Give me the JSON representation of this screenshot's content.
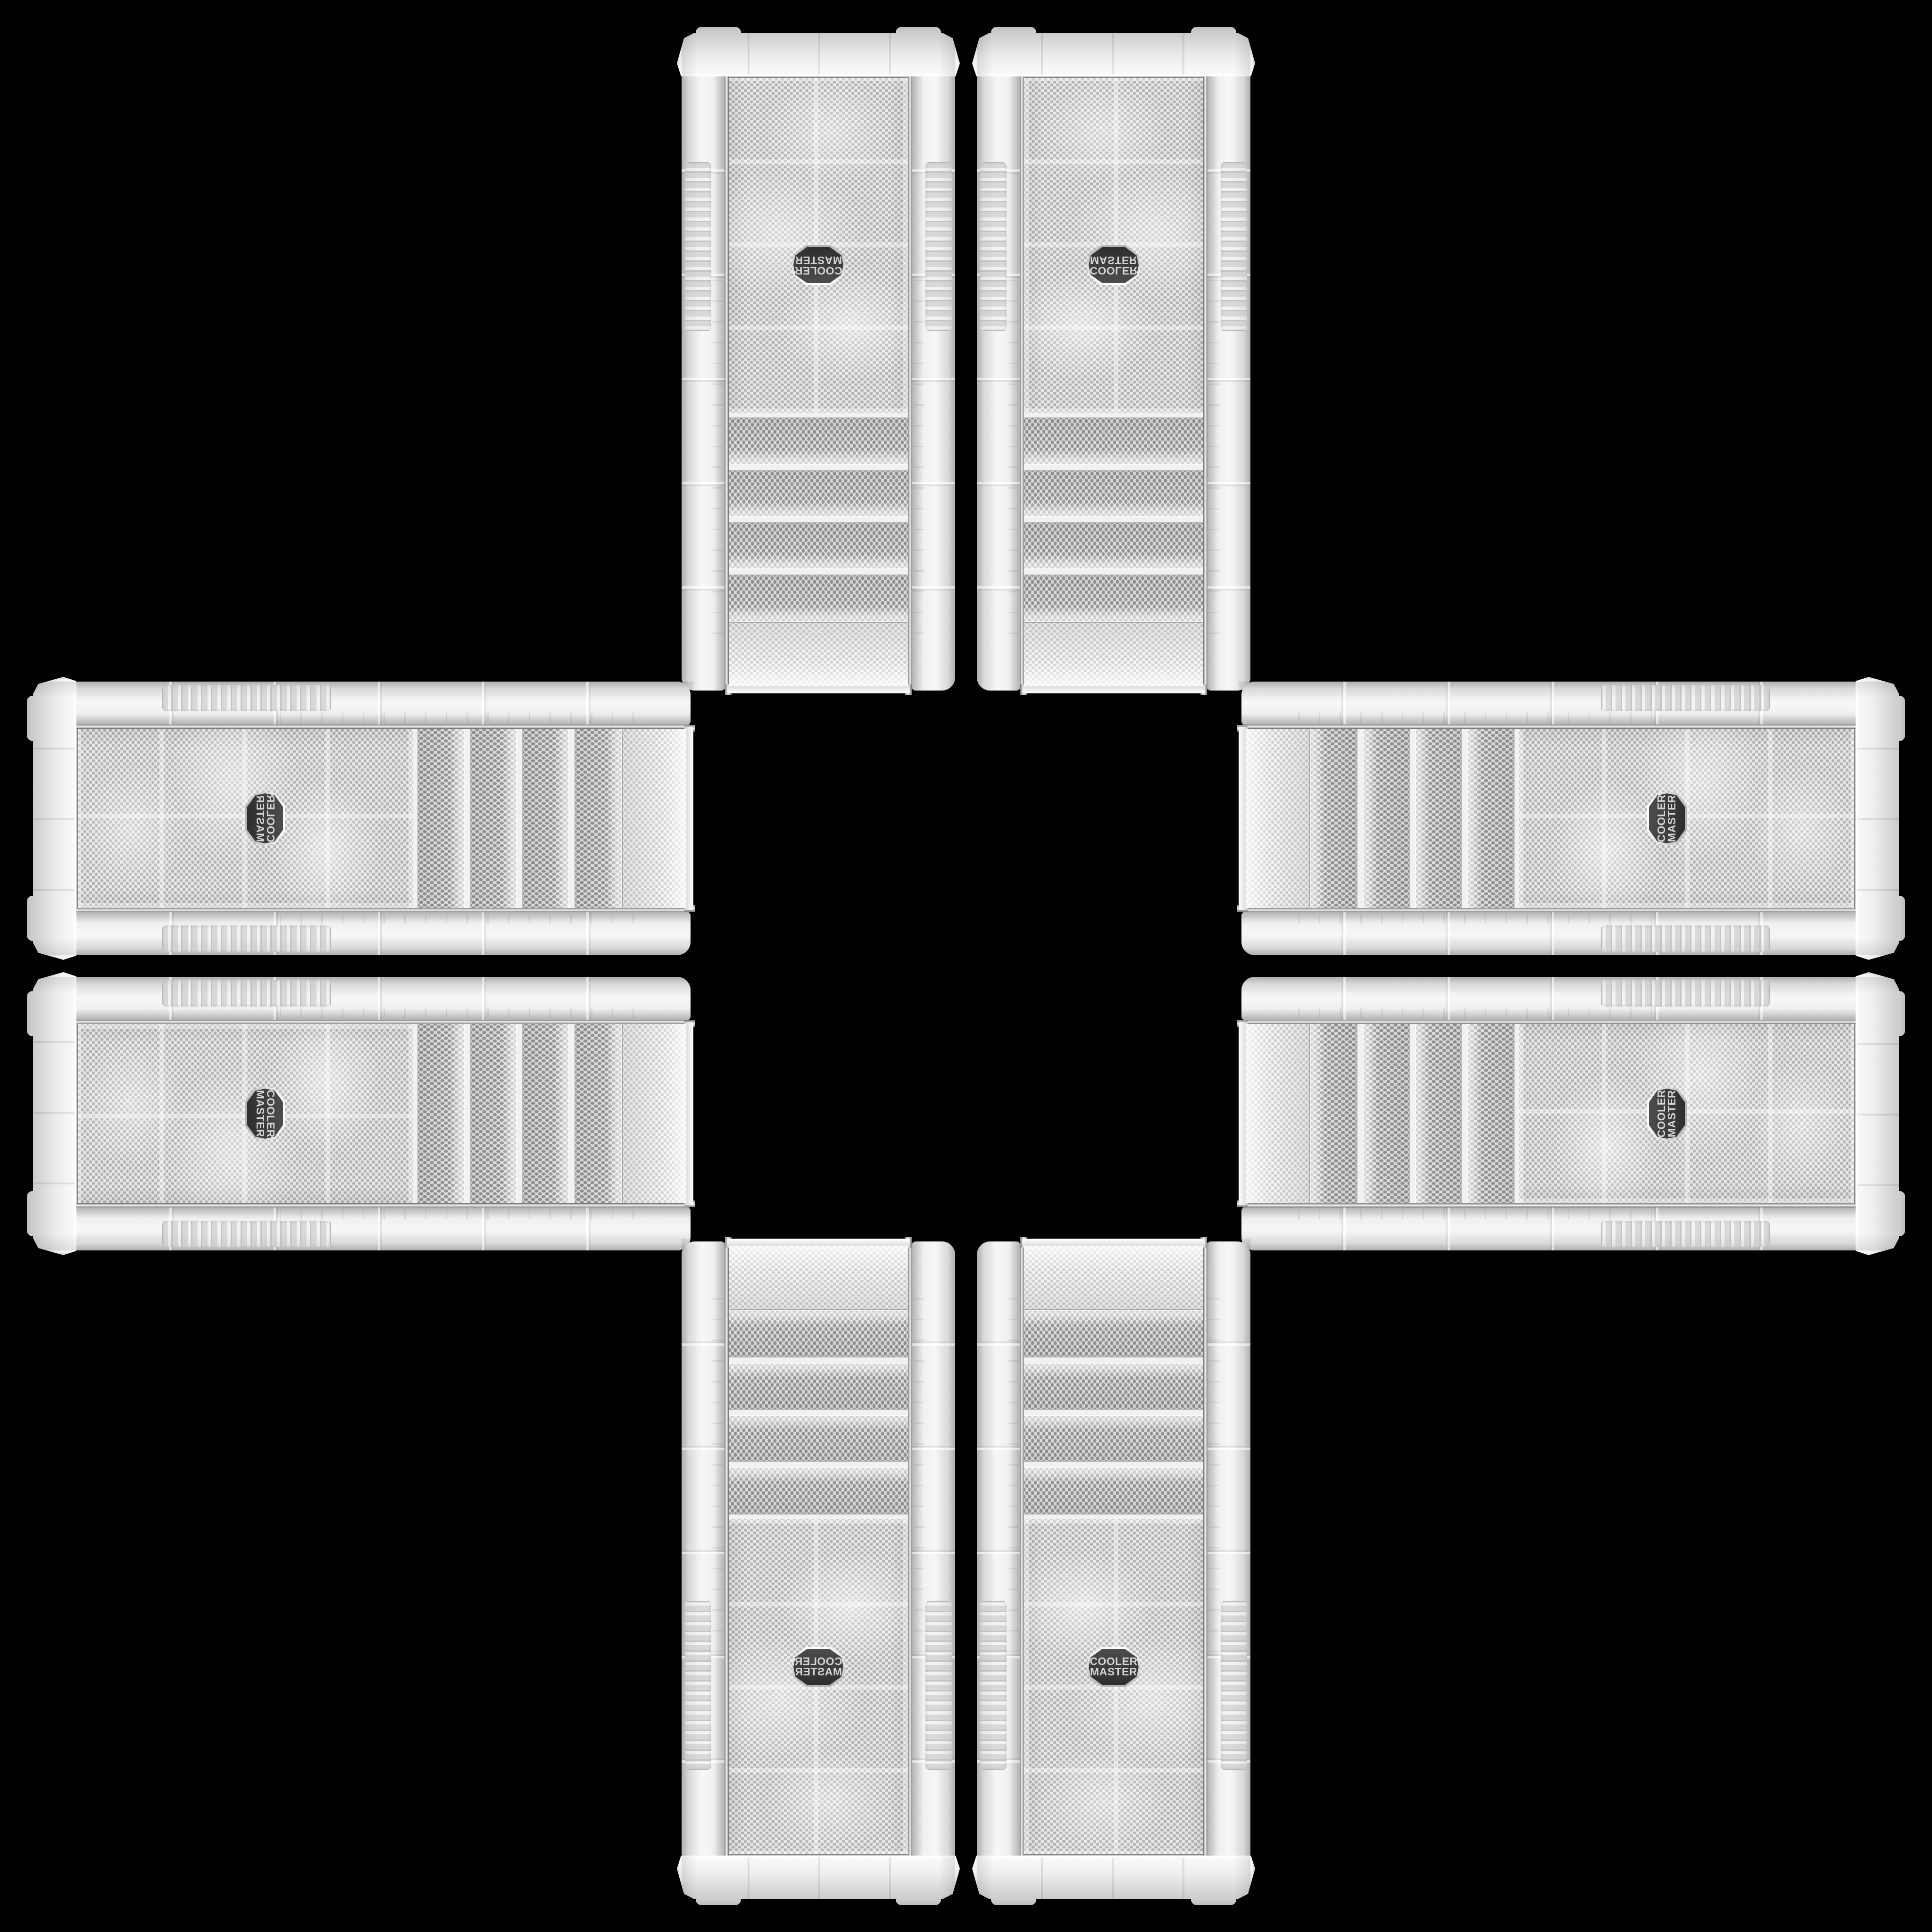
{
  "scene": {
    "background": "#000000",
    "layout": "cross-collage",
    "case_count": 8
  },
  "brand": {
    "line1": "COOLER",
    "line2": "MASTER"
  },
  "colors": {
    "background": "#000000",
    "case_body": "#ededed",
    "mesh_light": "#e9e9e9",
    "mesh_dot": "#9b9b9b",
    "chrome": "#8c8c8c",
    "badge_bg": "#39393b",
    "badge_text": "#d4d4d4"
  },
  "cases": {
    "instances": [
      {
        "name": "case-tower-top-left",
        "class": "tower-tl",
        "orientation": "rotated-180"
      },
      {
        "name": "case-tower-top-right",
        "class": "tower-tr",
        "orientation": "flipped-vertical"
      },
      {
        "name": "case-horizontal-left-top",
        "class": "horiz-lt",
        "orientation": "rotated-90ccw-mirrored-horizontal"
      },
      {
        "name": "case-horizontal-right-top",
        "class": "horiz-rt",
        "orientation": "rotated-90ccw"
      },
      {
        "name": "case-horizontal-left-bottom",
        "class": "horiz-lb",
        "orientation": "rotated-90ccw-rotated-180"
      },
      {
        "name": "case-horizontal-right-bottom",
        "class": "horiz-rb",
        "orientation": "rotated-90ccw-flipped-vertical"
      },
      {
        "name": "case-tower-bottom-left",
        "class": "tower-bl",
        "orientation": "mirrored-horizontal"
      },
      {
        "name": "case-tower-bottom-right",
        "class": "tower-br",
        "orientation": "upright"
      }
    ]
  }
}
